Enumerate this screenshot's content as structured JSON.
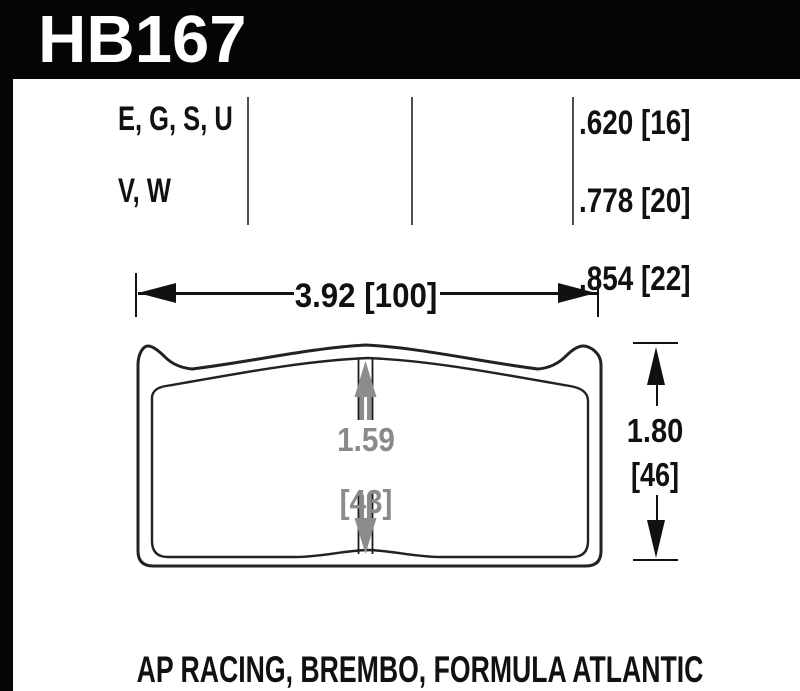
{
  "part_number": "HB167",
  "compounds": {
    "line1": "E, G, S, U",
    "line2": "V, W"
  },
  "pad_thicknesses": [
    ".620 [16]",
    ".778 [20]",
    ".854 [22]"
  ],
  "dimensions": {
    "width": "3.92 [100]",
    "height_in": "1.80",
    "height_mm": "[46]",
    "center_in": "1.59",
    "center_mm": "[43]"
  },
  "applications": "AP RACING, BREMBO, FORMULA ATLANTIC",
  "colors": {
    "banner_background": "#050505",
    "banner_text": "#ffffff",
    "ink": "#111111",
    "outline": "#222222",
    "divider": "#4f4f4f",
    "center_dimension_gray": "#8a8a8a",
    "background": "#ffffff"
  }
}
